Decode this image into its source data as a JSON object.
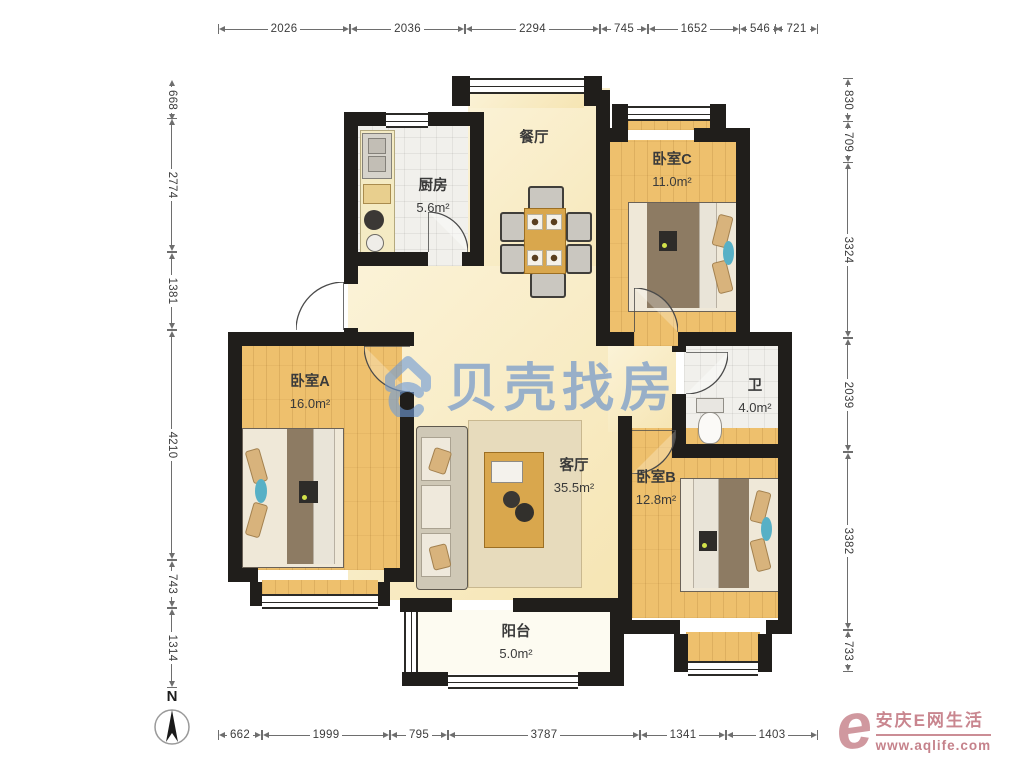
{
  "title": "三室两厅户型图",
  "dimensions": {
    "top": [
      "2026",
      "2036",
      "2294",
      "745",
      "1652",
      "546",
      "721"
    ],
    "left": [
      "668",
      "2774",
      "1381",
      "4210",
      "743",
      "1314"
    ],
    "right": [
      "830",
      "709",
      "3324",
      "2039",
      "3382",
      "733"
    ],
    "bottom": [
      "662",
      "1999",
      "795",
      "3787",
      "1341",
      "1403"
    ]
  },
  "rooms": {
    "dining": {
      "name": "餐厅",
      "area": ""
    },
    "kitchen": {
      "name": "厨房",
      "area": "5.6m²"
    },
    "bedroom_c": {
      "name": "卧室C",
      "area": "11.0m²"
    },
    "bathroom": {
      "name": "卫",
      "area": "4.0m²"
    },
    "bedroom_a": {
      "name": "卧室A",
      "area": "16.0m²"
    },
    "living": {
      "name": "客厅",
      "area": "35.5m²"
    },
    "bedroom_b": {
      "name": "卧室B",
      "area": "12.8m²"
    },
    "balcony": {
      "name": "阳台",
      "area": "5.0m²"
    }
  },
  "watermark": {
    "brand": "贝壳找房"
  },
  "site_watermark": {
    "name": "安庆E网生活",
    "url": "www.aqlife.com"
  },
  "compass": {
    "label": "N"
  },
  "colors": {
    "wall": "#201e1b",
    "wood_floor": "#eec06d",
    "hall_floor": "#f9ecc2",
    "tile_floor": "#f1f0ec",
    "watermark_blue": "#5f8ccc",
    "site_pink": "#cb8d95"
  }
}
